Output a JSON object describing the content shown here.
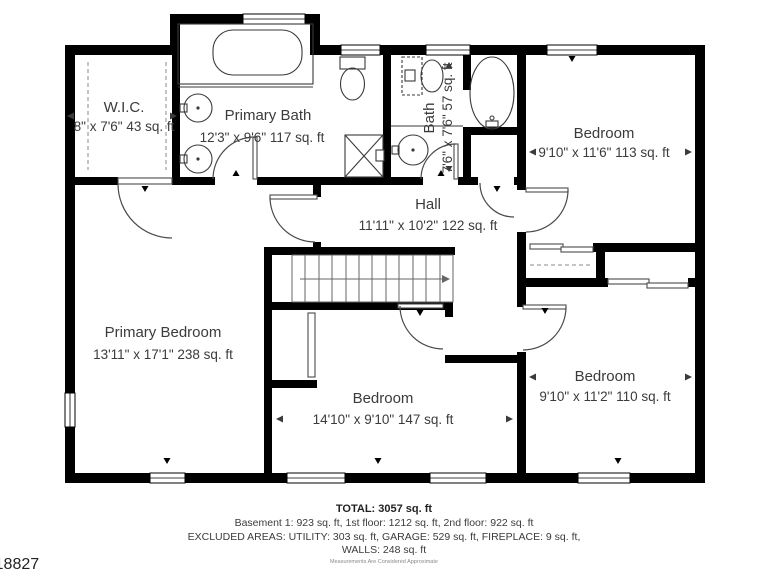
{
  "floor_plan": {
    "rooms": {
      "wic": {
        "name": "W.I.C.",
        "dims": "8\" x 7'6\" 43 sq. ft"
      },
      "primary_bath": {
        "name": "Primary Bath",
        "dims": "12'3\" x 9'6\" 117 sq. ft"
      },
      "bath": {
        "name": "Bath",
        "dims": "7'6\" x 7'6\" 57 sq. ft"
      },
      "bedroom_top_right": {
        "name": "Bedroom",
        "dims": "9'10\" x 11'6\" 113 sq. ft"
      },
      "hall": {
        "name": "Hall",
        "dims": "11'11\" x 10'2\" 122 sq. ft"
      },
      "primary_bedroom": {
        "name": "Primary Bedroom",
        "dims": "13'11\" x 17'1\" 238 sq. ft"
      },
      "bedroom_bottom_middle": {
        "name": "Bedroom",
        "dims": "14'10\" x 9'10\" 147 sq. ft"
      },
      "bedroom_bottom_right": {
        "name": "Bedroom",
        "dims": "9'10\" x 11'2\" 110 sq. ft"
      }
    },
    "summary": {
      "total": "TOTAL: 3057 sq. ft",
      "floors": "Basement 1: 923 sq. ft, 1st floor: 1212 sq. ft, 2nd floor: 922 sq. ft",
      "excluded": "EXCLUDED AREAS: UTILITY: 303 sq. ft, GARAGE: 529 sq. ft, FIREPLACE: 9 sq. ft,",
      "excluded2": "WALLS: 248 sq. ft",
      "disclaimer": "Measurements Are Considered Approximate"
    },
    "listing_id": "5418827",
    "colors": {
      "wall": "#000000",
      "background": "#ffffff",
      "text": "#3b3b3b"
    }
  }
}
